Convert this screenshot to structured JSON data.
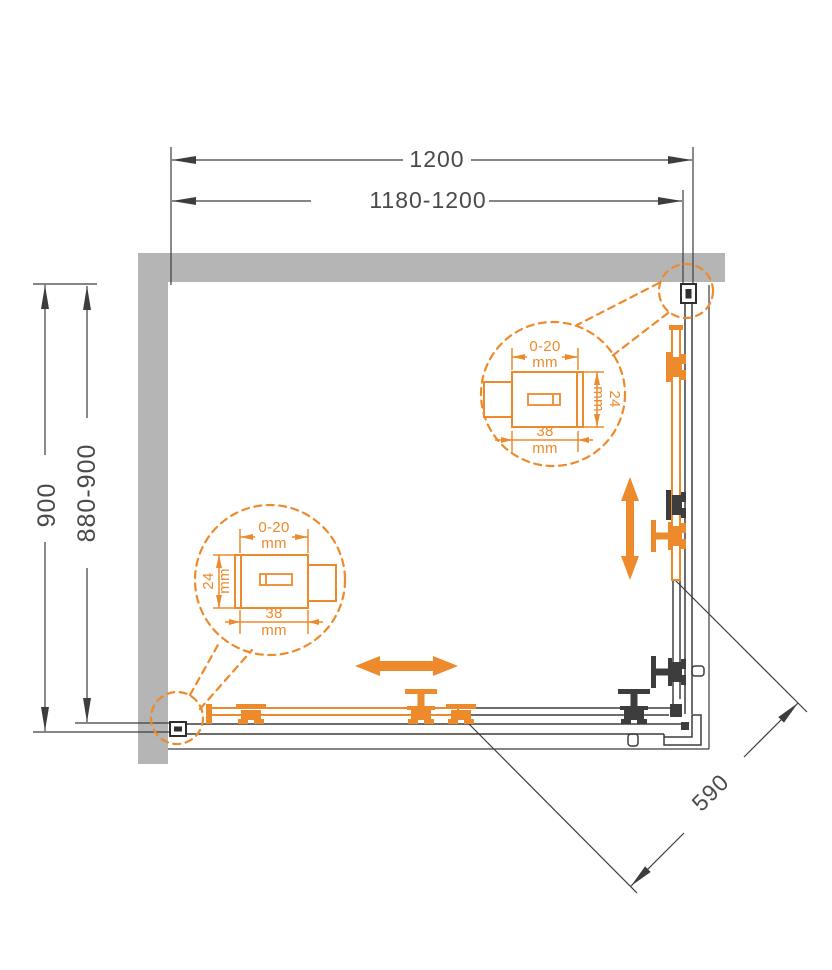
{
  "diagram": {
    "dimensions": {
      "width_total": "1200",
      "width_range": "1180-1200",
      "depth_total": "900",
      "depth_range": "880-900",
      "entry_diagonal": "590"
    },
    "profile_detail": {
      "adjustment_range": "0-20",
      "unit": "mm",
      "profile_depth": "24",
      "profile_width": "38"
    },
    "colors": {
      "accent": "#ED8A2B",
      "wall": "#B5B5B5",
      "line": "#3D3D3D",
      "text": "#4A4A4A"
    }
  }
}
